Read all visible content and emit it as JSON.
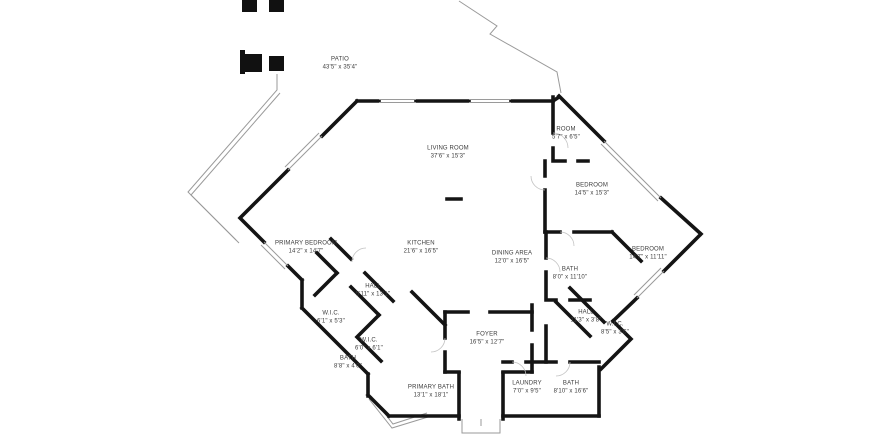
{
  "plan": {
    "type": "floor-plan",
    "colors": {
      "wall": "#141414",
      "window_line": "#9a9a9a",
      "label_text": "#3c3c3c",
      "background": "#ffffff"
    },
    "rooms": [
      {
        "name": "PATIO",
        "dims": "43'5\" x 35'4\""
      },
      {
        "name": "LIVING ROOM",
        "dims": "37'6\" x 15'3\""
      },
      {
        "name": "ROOM",
        "dims": "5'7\" x 6'5\""
      },
      {
        "name": "BEDROOM",
        "dims": "14'5\" x 15'3\""
      },
      {
        "name": "BEDROOM",
        "dims": "14'7\" x 11'11\""
      },
      {
        "name": "PRIMARY BEDROOM",
        "dims": "14'2\" x 14'7\""
      },
      {
        "name": "KITCHEN",
        "dims": "21'6\" x 16'5\""
      },
      {
        "name": "DINING AREA",
        "dims": "12'0\" x 16'5\""
      },
      {
        "name": "BATH",
        "dims": "8'0\" x 11'10\""
      },
      {
        "name": "HALL",
        "dims": "5'11\" x 13'1\""
      },
      {
        "name": "W.I.C.",
        "dims": "6'1\" x 5'3\""
      },
      {
        "name": "W.I.C.",
        "dims": "6'0\" x 6'1\""
      },
      {
        "name": "BATH",
        "dims": "8'8\" x 4'0\""
      },
      {
        "name": "FOYER",
        "dims": "16'5\" x 12'7\""
      },
      {
        "name": "HALL",
        "dims": "11'3\" x 3'8\""
      },
      {
        "name": "W.I.C.",
        "dims": "8'5\" x 3'6\""
      },
      {
        "name": "PRIMARY BATH",
        "dims": "13'1\" x 18'1\""
      },
      {
        "name": "LAUNDRY",
        "dims": "7'0\" x 9'5\""
      },
      {
        "name": "BATH",
        "dims": "8'10\" x 16'6\""
      }
    ]
  }
}
